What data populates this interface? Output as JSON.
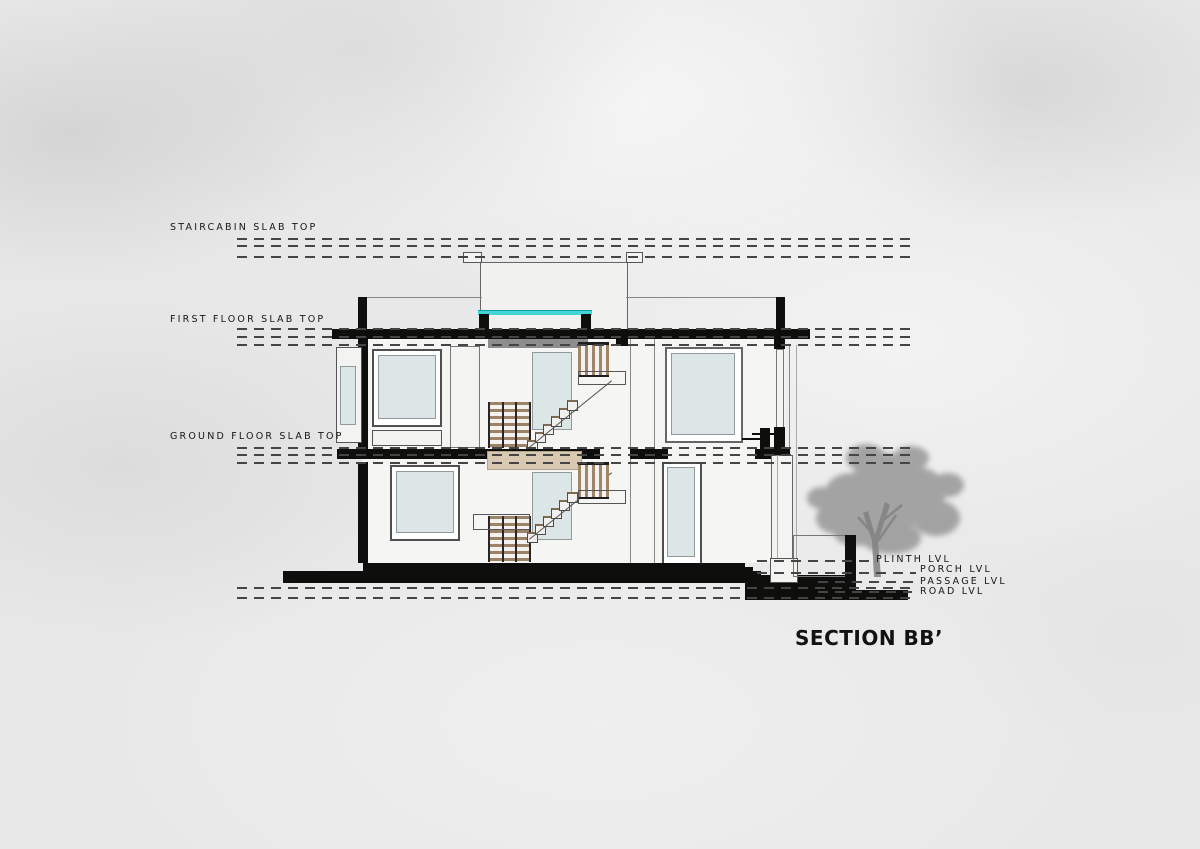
{
  "drawing": {
    "title": "SECTION BB’",
    "left_levels": [
      {
        "id": "staircabin",
        "label": "STAIRCABIN SLAB TOP"
      },
      {
        "id": "first-floor",
        "label": "FIRST FLOOR SLAB TOP"
      },
      {
        "id": "ground-floor",
        "label": "GROUND FLOOR SLAB TOP"
      }
    ],
    "right_levels": [
      {
        "id": "plinth",
        "label": "PLINTH LVL"
      },
      {
        "id": "porch",
        "label": "PORCH LVL"
      },
      {
        "id": "passage",
        "label": "PASSAGE LVL"
      },
      {
        "id": "road",
        "label": "ROAD LVL"
      }
    ],
    "colors": {
      "cut_black": "#0e0e0d",
      "skylight_cyan": "#3fd6d3",
      "wood_tan": "#a08566",
      "landing_beige": "#d9c8b2",
      "glass_blue": "#dde6e7",
      "soffit_gray": "#8d8d8d",
      "tree_gray": "#8f8f8f",
      "background_gray": "#e8e8e8"
    }
  }
}
